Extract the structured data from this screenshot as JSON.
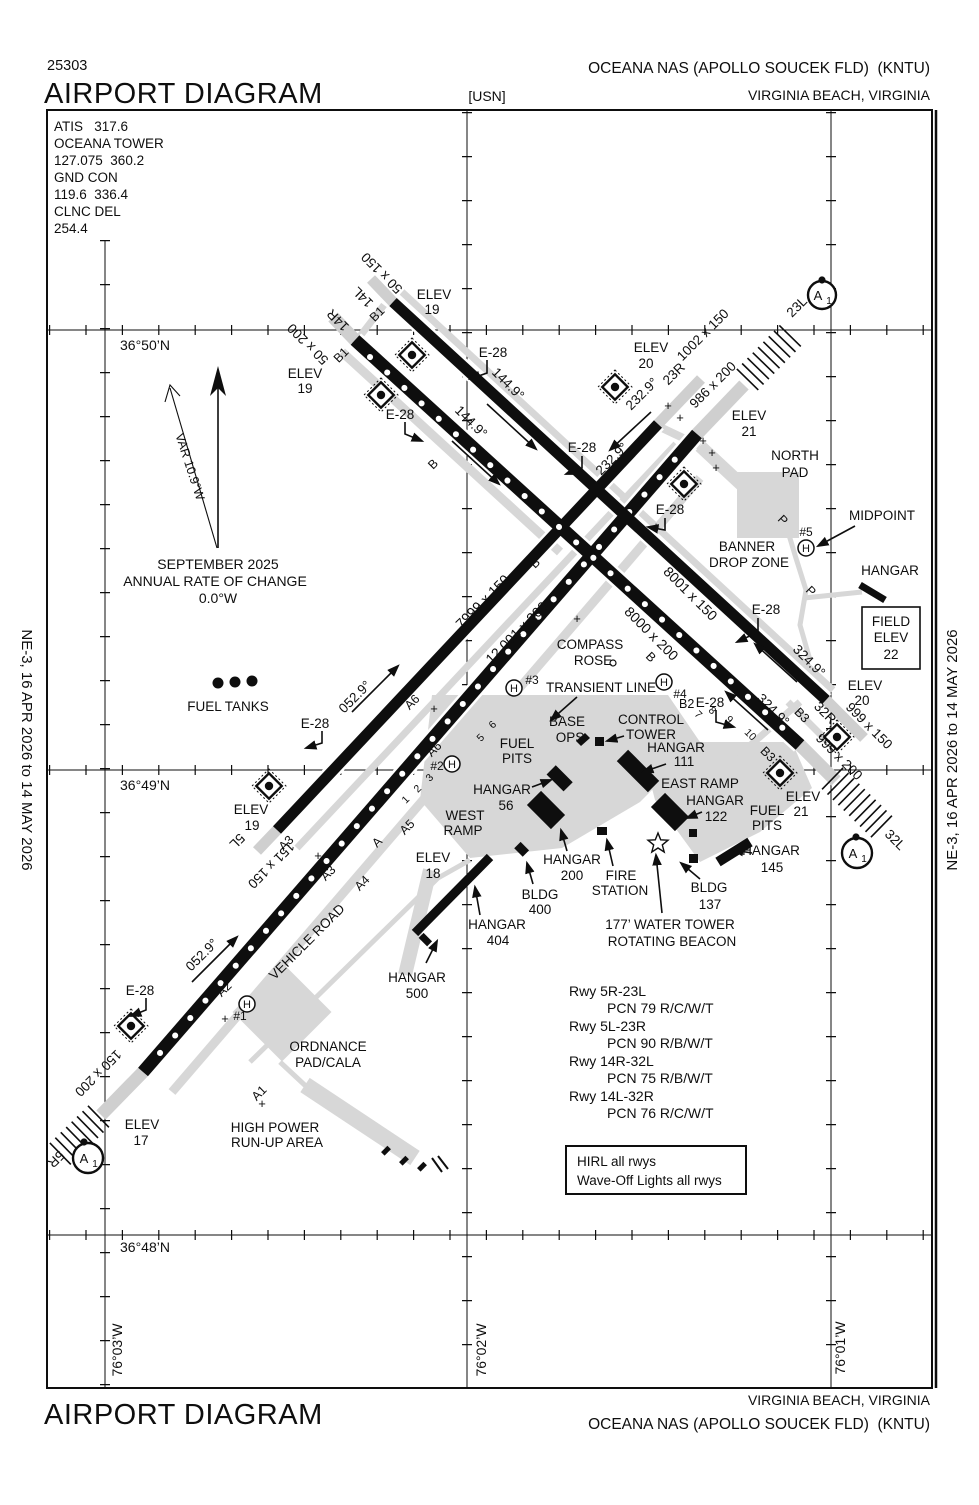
{
  "header": {
    "chart_number": "25303",
    "title": "AIRPORT DIAGRAM",
    "branch": "[USN]",
    "airport_name": "OCEANA NAS (APOLLO SOUCEK FLD)  (KNTU)",
    "city": "VIRGINIA BEACH, VIRGINIA"
  },
  "footer": {
    "title": "AIRPORT DIAGRAM",
    "airport_name": "OCEANA NAS (APOLLO SOUCEK FLD)  (KNTU)",
    "city": "VIRGINIA BEACH, VIRGINIA"
  },
  "margins": {
    "left": "NE-3, 16 APR 2026 to 14 MAY 2026",
    "right": "NE-3, 16 APR 2026 to 14 MAY 2026"
  },
  "comms": {
    "lines": [
      "ATIS   317.6",
      "OCEANA TOWER",
      "127.075  360.2",
      "GND CON",
      "119.6  336.4",
      "CLNC DEL",
      "254.4"
    ]
  },
  "variation": {
    "var_label": "VAR 10.9°W",
    "line1": "SEPTEMBER 2025",
    "line2": "ANNUAL RATE OF CHANGE",
    "line3": "0.0°W"
  },
  "graticule": {
    "lat_50": "36°50’N",
    "lat_49": "36°49’N",
    "lat_48": "36°48’N",
    "lon_03": "76°03’W",
    "lon_02": "76°02’W",
    "lon_01": "76°01’W"
  },
  "runways": {
    "rwy_5r_23l": {
      "dim": "12,001 x 200",
      "hdg_ne": "052.9°",
      "hdg_sw": "232.9°"
    },
    "rwy_5l_23r": {
      "dim": "7999 x 150"
    },
    "rwy_14l_32r": {
      "dim": "8001 x 150",
      "hdg_se": "144.9°",
      "hdg_nw": "324.9°"
    },
    "rwy_14r_32l": {
      "dim": "8000 x 200"
    }
  },
  "labels": {
    "e28": "E-28",
    "hdg_1449": "144.9°",
    "hdg_2329": "232.9°",
    "hdg_0529": "052.9°",
    "hdg_3249": "324.9°",
    "rwy14l": "14L",
    "rwy14r": "14R",
    "rwy23l": "23L",
    "rwy23r": "23R",
    "rwy5l": "5L",
    "rwy5r": "5R",
    "rwy32l": "32L",
    "rwy32r": "32R",
    "dim_5r_23l": "12,001 x 200",
    "dim_5l_23r": "7999 x 150",
    "dim_14l_32r": "8001 x 150",
    "dim_14r_32l": "8000 x 200",
    "ovr_14l": "50 x 150",
    "ovr_14r": "50 x 200",
    "ovr_23l": "1002 x 150",
    "ovr_23r": "986 x 200",
    "ovr_5l": "151 x 150",
    "ovr_5r": "150 x 200",
    "ovr_32r": "999 x 150",
    "ovr_32l": "999 x 200",
    "elev": "ELEV",
    "elev17": "17",
    "elev18": "18",
    "elev19": "19",
    "elev20": "20",
    "elev21": "21",
    "field_elev_1": "FIELD",
    "field_elev_2": "ELEV",
    "field_elev_3": "22",
    "north_pad_1": "NORTH",
    "north_pad_2": "PAD",
    "banner_1": "BANNER",
    "banner_2": "DROP ZONE",
    "midpoint": "MIDPOINT",
    "hangar": "HANGAR",
    "compass_1": "COMPASS",
    "compass_2": "ROSE",
    "transient": "TRANSIENT LINE",
    "base_1": "BASE",
    "base_2": "OPS",
    "tower_1": "CONTROL",
    "tower_2": "TOWER",
    "fuel_1": "FUEL",
    "fuel_2": "PITS",
    "fuel_tanks": "FUEL TANKS",
    "east_ramp": "EAST RAMP",
    "west_1": "WEST",
    "west_2": "RAMP",
    "h111": "111",
    "h56": "56",
    "h122": "122",
    "h145": "145",
    "h200": "200",
    "h404": "404",
    "h500": "500",
    "bldg": "BLDG",
    "b400": "400",
    "b137": "137",
    "fire_1": "FIRE",
    "fire_2": "STATION",
    "water_1": "177’ WATER TOWER",
    "water_2": "ROTATING BEACON",
    "ordnance_1": "ORDNANCE",
    "ordnance_2": "PAD/CALA",
    "runup_1": "HIGH POWER",
    "runup_2": "RUN-UP AREA",
    "vehicle_road": "VEHICLE ROAD",
    "twy_a": "A",
    "twy_a1": "A1",
    "twy_a2": "A2",
    "twy_a3": "A3",
    "twy_a4": "A4",
    "twy_a5": "A5",
    "twy_a6": "A6",
    "twy_b": "B",
    "twy_b1": "B1",
    "twy_b2": "B2",
    "twy_b3": "B3",
    "twy_p": "P",
    "n1": "1",
    "n2": "2",
    "n3": "3",
    "n5": "5",
    "n6": "6",
    "n7": "7",
    "n8": "8",
    "n9": "9",
    "n10": "10",
    "h_mark": "H",
    "hp1": "#1",
    "hp2": "#2",
    "hp3": "#3",
    "hp4": "#4",
    "hp5": "#5",
    "a1_letter": "A",
    "a1_sub": "1",
    "plus": "+"
  },
  "pcn": {
    "rows": [
      {
        "rwy": "Rwy 5R-23L",
        "pcn": "PCN 79 R/C/W/T"
      },
      {
        "rwy": "Rwy 5L-23R",
        "pcn": "PCN 90 R/B/W/T"
      },
      {
        "rwy": "Rwy 14R-32L",
        "pcn": "PCN 75 R/B/W/T"
      },
      {
        "rwy": "Rwy 14L-32R",
        "pcn": "PCN 76 R/C/W/T"
      }
    ]
  },
  "lighting_box": {
    "line1": "HIRL all rwys",
    "line2": "Wave-Off Lights all rwys"
  }
}
